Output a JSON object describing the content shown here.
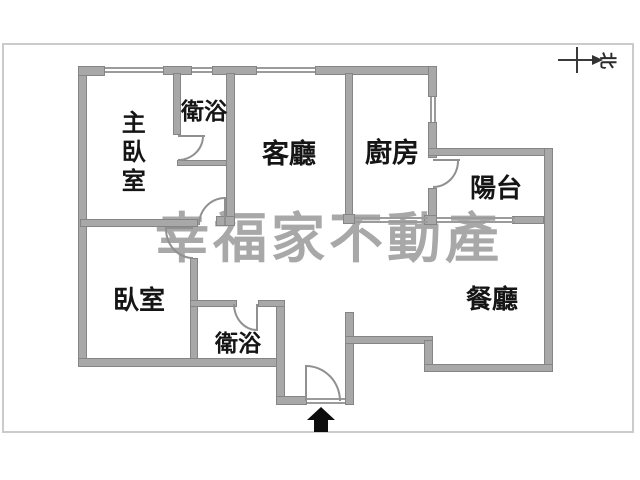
{
  "floorplan": {
    "watermark": "幸福家不動產",
    "compass": {
      "label": "北"
    },
    "rooms": [
      {
        "id": "master-bedroom",
        "label": "主臥室"
      },
      {
        "id": "bathroom-ensuite",
        "label": "衛浴"
      },
      {
        "id": "living-room",
        "label": "客廳"
      },
      {
        "id": "kitchen",
        "label": "廚房"
      },
      {
        "id": "balcony",
        "label": "陽台"
      },
      {
        "id": "bedroom",
        "label": "臥室"
      },
      {
        "id": "bathroom",
        "label": "衛浴"
      },
      {
        "id": "dining-room",
        "label": "餐廳"
      }
    ]
  }
}
